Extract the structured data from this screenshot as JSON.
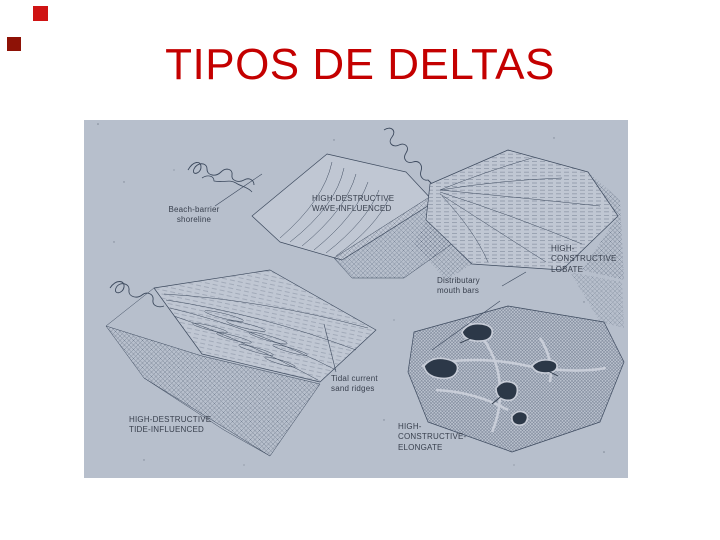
{
  "slide": {
    "title": "TIPOS DE DELTAS",
    "title_color": "#c40000",
    "background_color": "#ffffff",
    "decor_squares": [
      {
        "name": "top-square",
        "color": "#cf1313"
      },
      {
        "name": "left-square",
        "color": "#8e1206"
      }
    ]
  },
  "figure": {
    "background_color": "#b7bfcc",
    "ink_color": "#3a4454",
    "labels": {
      "beach_barrier": "Beach-barrier\nshoreline",
      "wave": "HIGH-DESTRUCTIVE\nWAVE-INFLUENCED",
      "lobate": "HIGH-\nCONSTRUCTIVE\nLOBATE",
      "distributary": "Distributary\nmouth bars",
      "tidal": "Tidal current\nsand ridges",
      "tide": "HIGH-DESTRUCTIVE\nTIDE-INFLUENCED",
      "elongate": "HIGH-\nCONSTRUCTIVE-\nELONGATE"
    }
  }
}
